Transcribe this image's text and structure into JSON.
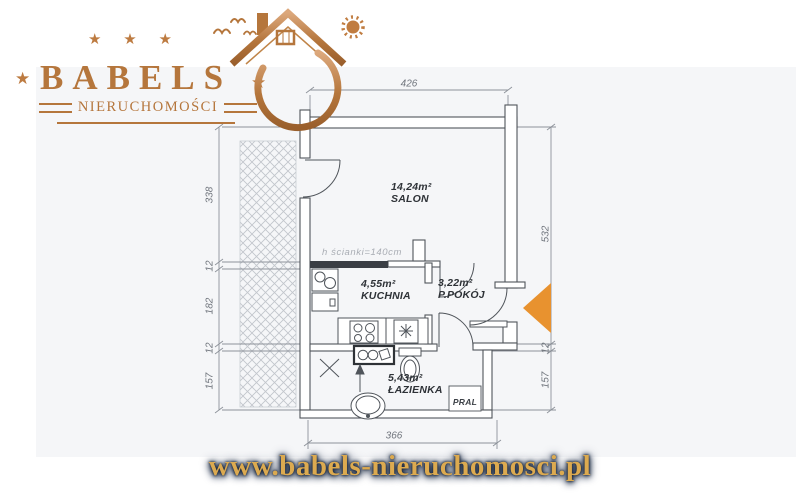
{
  "logo": {
    "brand": "BABELS",
    "subtitle": "NIERUCHOMOŚCI",
    "star": "★",
    "colors": {
      "copper": "#b5763c",
      "copper_light": "#d9a878"
    }
  },
  "plan": {
    "rooms": [
      {
        "area": "14,24m²",
        "name": "SALON"
      },
      {
        "area": "4,55m²",
        "name": "KUCHNIA"
      },
      {
        "area": "3,22m²",
        "name": "P.POKÓJ"
      },
      {
        "area": "5,43m²",
        "name": "ŁAZIENKA"
      }
    ],
    "annotations": {
      "wall_height": "h ścianki=140cm",
      "washer_closet": "PRAL"
    },
    "dimensions": {
      "top_width": "426",
      "bottom_width": "366",
      "left": [
        "338",
        "12",
        "182",
        "12",
        "157"
      ],
      "right": [
        "532",
        "12",
        "157"
      ]
    },
    "colors": {
      "entrance_arrow": "#E8922F",
      "line": "#50555b"
    }
  },
  "footer": {
    "url": "www.babels-nieruchomosci.pl"
  }
}
